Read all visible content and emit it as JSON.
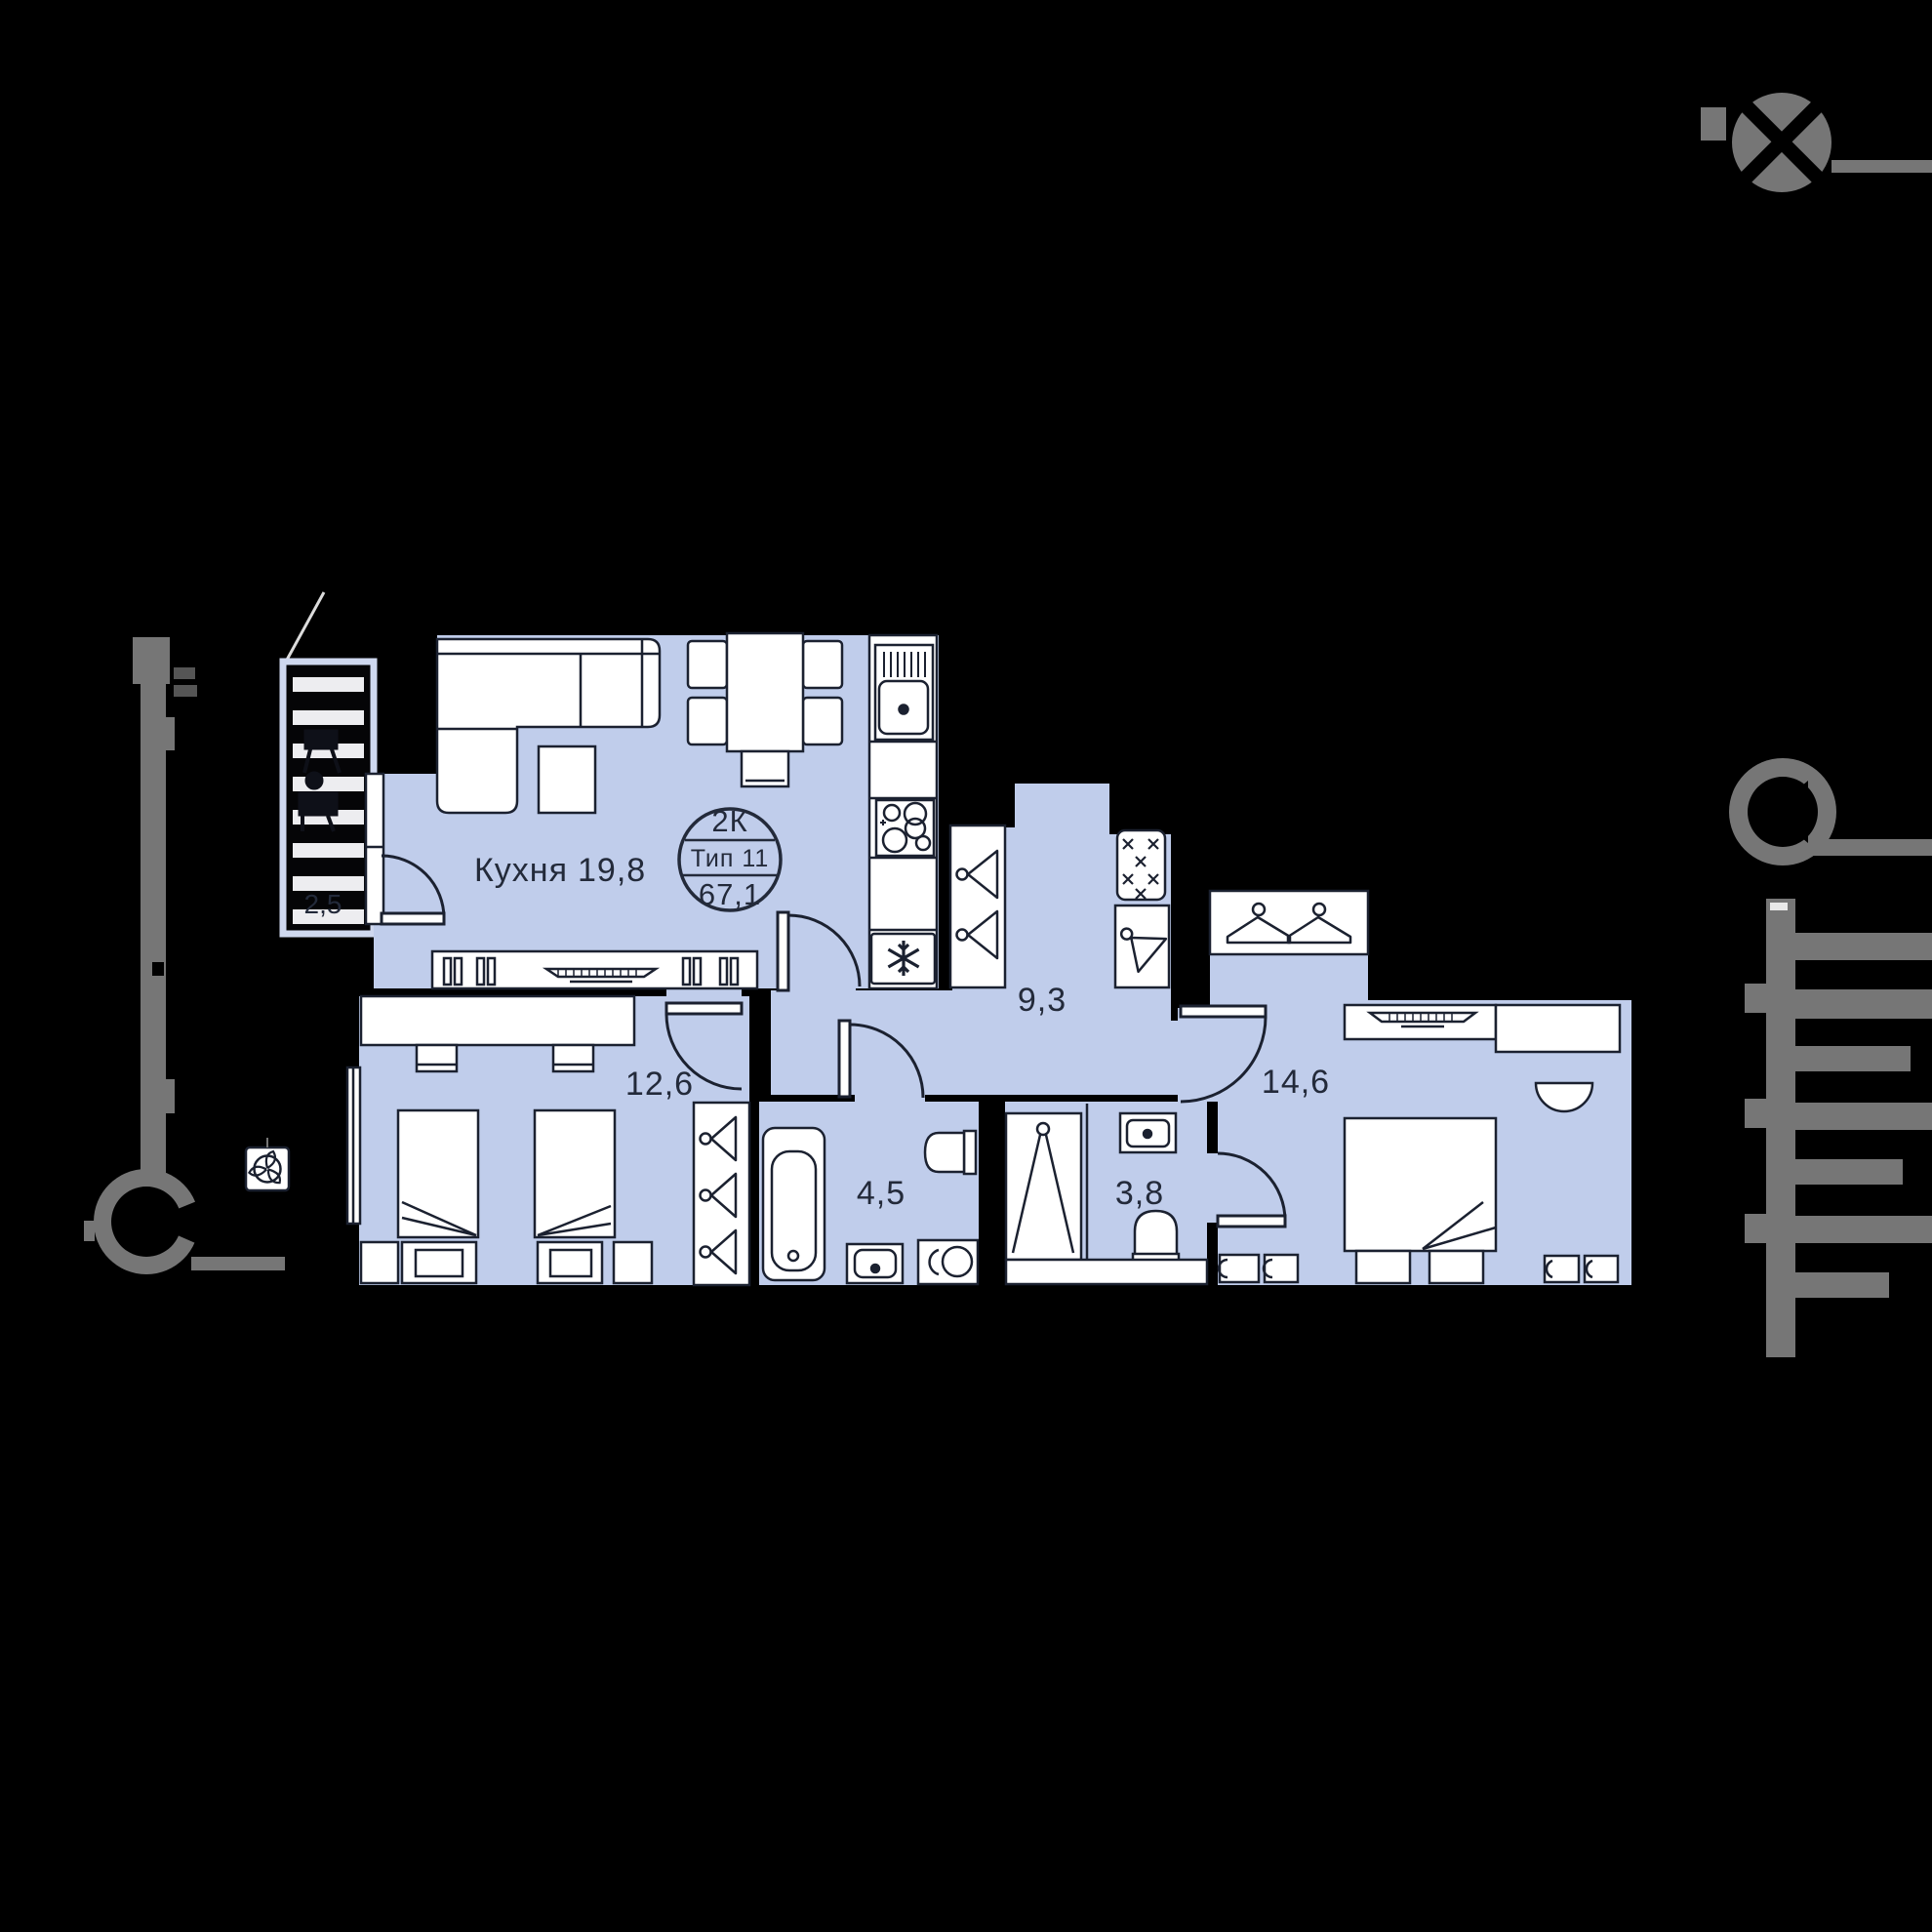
{
  "plan": {
    "badge": {
      "rooms": "2К",
      "type": "Тип 11",
      "area": "67,1"
    },
    "rooms": [
      {
        "id": "kitchen-living",
        "name": "Кухня",
        "area": "19,8"
      },
      {
        "id": "bedroom-1",
        "name": "",
        "area": "12,6"
      },
      {
        "id": "hallway",
        "name": "",
        "area": "9,3"
      },
      {
        "id": "bedroom-2",
        "name": "",
        "area": "14,6"
      },
      {
        "id": "bathroom",
        "name": "",
        "area": "4,5"
      },
      {
        "id": "wc",
        "name": "",
        "area": "3,8"
      },
      {
        "id": "balcony",
        "name": "",
        "area": "2,5"
      }
    ],
    "colors": {
      "background": "#000000",
      "room_fill": "#c0cdeb",
      "furniture_fill": "#ffffff",
      "line": "#1b2130",
      "decor_gray": "#767676",
      "railing_stripe": "#ededf0"
    },
    "icons": [
      "snowflake-fridge-icon",
      "fan-vent-icon",
      "hanger-icon",
      "stove-burners-icon",
      "sink-icon",
      "bathtub-icon",
      "toilet-icon",
      "washing-machine-icon",
      "compass-decor-icon"
    ]
  }
}
